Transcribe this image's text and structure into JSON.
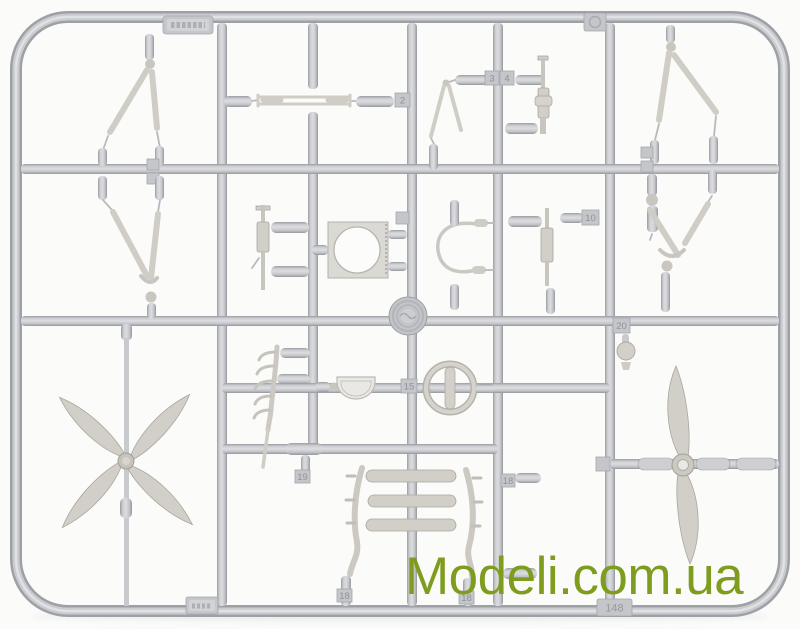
{
  "photo": {
    "subject": "Light gray injection-molded plastic model kit sprue with biplane aircraft parts (four-blade propeller, two-blade propeller, cabane struts, machine guns, cowling ring plate, windscreen, engine mount cage, spinner ball) photographed on a white background",
    "watermark": {
      "text": "Modeli.com.ua",
      "color": "#7e9c1e"
    },
    "colors": {
      "background": "#fbfbfa",
      "plastic_base": "#c6c7cb",
      "plastic_shadow": "#9b9da2",
      "plastic_highlight": "#dcdde0",
      "parts_tint": "#d2cfc8"
    },
    "part_number_labels": {
      "n2": "2",
      "n3": "3",
      "n4": "4",
      "n10": "10",
      "n15": "15",
      "n18": "18",
      "n19": "19",
      "n20": "20",
      "scale": "148"
    }
  }
}
